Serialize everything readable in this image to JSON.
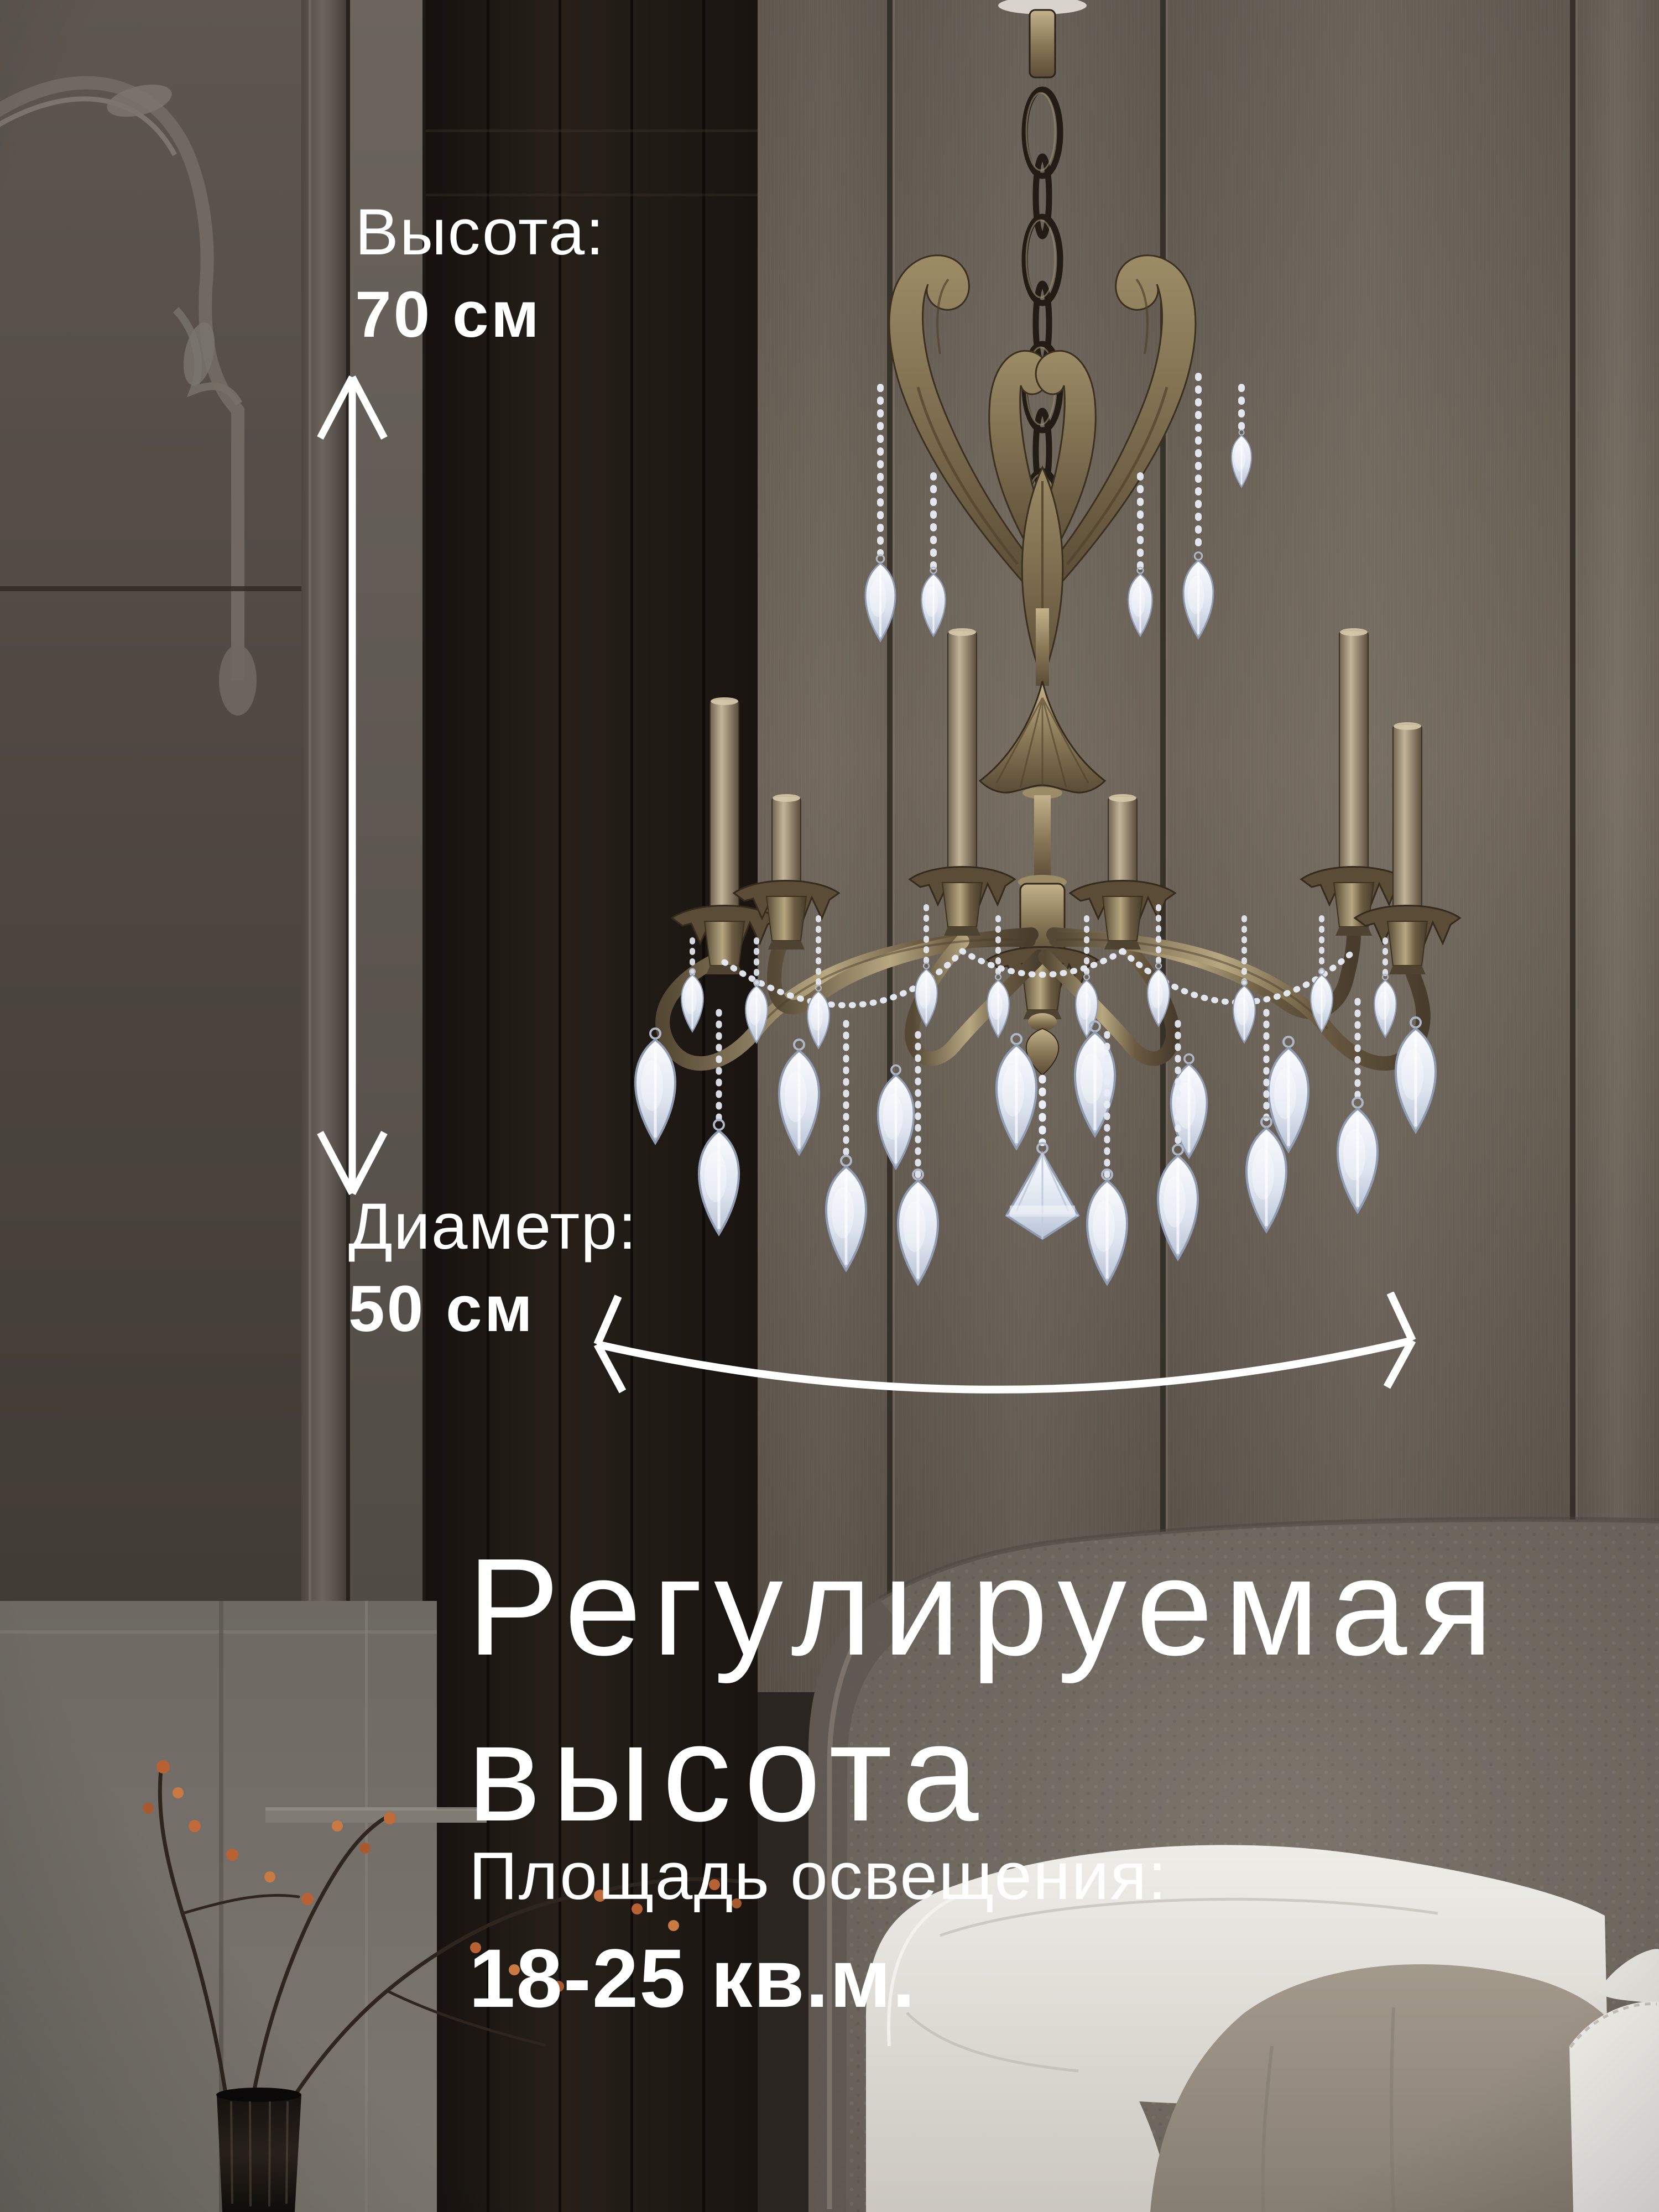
{
  "banner": {
    "annotations": {
      "height": {
        "label": "Высота:",
        "value": "70 см"
      },
      "diameter": {
        "label": "Диаметр:",
        "value": "50 см"
      },
      "headline": {
        "line1": "Регулируемая",
        "line2": "высота"
      },
      "area": {
        "label": "Площадь освещения:",
        "value": "18-25 кв.м."
      }
    },
    "icons": [
      {
        "name": "height-arrow-icon",
        "shape": "vertical double-headed measurement arrow",
        "glyph": "↕"
      },
      {
        "name": "diameter-arrow-icon",
        "shape": "curved horizontal double-headed measurement arrow",
        "glyph": "↔"
      }
    ],
    "palette": {
      "annotation_text": "#ffffff",
      "wall_panel": "#655c52",
      "left_wall": "#544e47",
      "doorway": "#1b1613",
      "lower_wall": "#736e67",
      "headboard": "#6f6860",
      "pillow_white": "#e7e4de",
      "pillow_beige": "#948b7e",
      "brass": "#8a7a58",
      "crystal": "#dfe7f2",
      "berries": "#bf6a38",
      "vase": "#1d1814"
    }
  }
}
